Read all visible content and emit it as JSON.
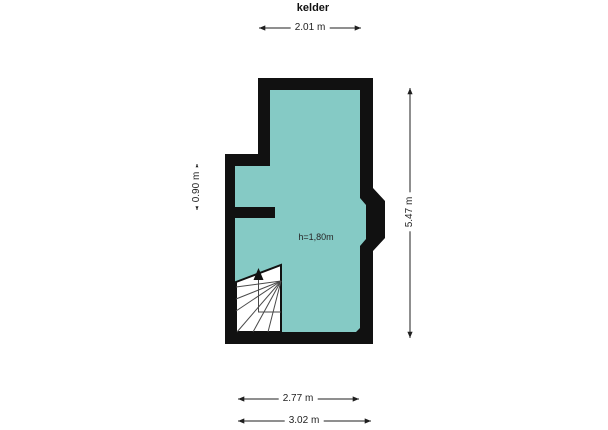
{
  "title": "kelder",
  "floorplan": {
    "room_height_label": "h=1,80m",
    "stairs_direction": "up"
  },
  "dimensions": {
    "top_width": "2.01 m",
    "left_height": "0.90 m",
    "right_height": "5.47 m",
    "bottom_inner_width": "2.77 m",
    "bottom_outer_width": "3.02 m"
  },
  "colors": {
    "background": "#ffffff",
    "wall": "#111111",
    "floor": "#85cac5",
    "stairs_fill": "#ffffff",
    "stair_treads": "#4a4a4a",
    "dimension": "#1f1f1f"
  }
}
